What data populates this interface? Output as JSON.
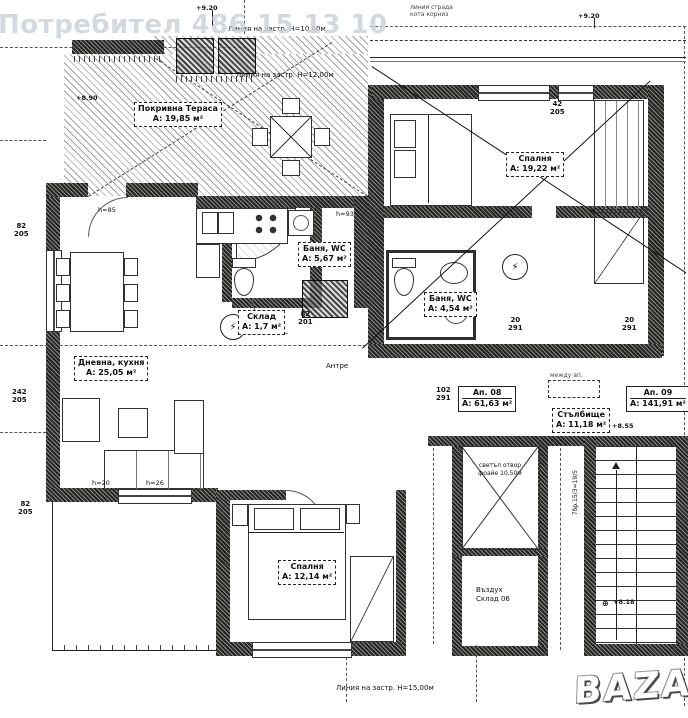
{
  "watermarks": {
    "user": "Потребител 486 15 13 10",
    "logo": "BAZAR"
  },
  "rooms": [
    {
      "name": "Покривна Тераса",
      "area": "А: 19,85 м²"
    },
    {
      "name": "Спалня",
      "area": "А: 19,22 м²"
    },
    {
      "name": "Баня, WC",
      "area": "А: 5,67 м²"
    },
    {
      "name": "Баня, WC",
      "area": "А: 4,54 м²"
    },
    {
      "name": "Склад",
      "area": "А: 1,7 м²"
    },
    {
      "name": "Дневна, кухня",
      "area": "А: 25,05 м²"
    },
    {
      "name": "Ап. 08",
      "area": "А: 61,63 м²"
    },
    {
      "name": "Стълбище",
      "area": "А: 11,18 м²"
    },
    {
      "name": "Ап. 09",
      "area": "А: 141,91 м²"
    },
    {
      "name": "Спалня",
      "area": "А: 12,14 м²"
    }
  ],
  "build_lines": [
    "Линия на застр. Н=10,00м",
    "Линия на застр. Н=12,00м",
    "Линия на застр. Н=15,00м"
  ],
  "small": {
    "top_right_1": "линия сграда",
    "top_right_2": "кота корниз",
    "between": "между ап.",
    "lift_1": "светъл отвор",
    "lift_2": "фоайе 10,50м",
    "air_1": "Въздух",
    "air_2": "Склад 06",
    "anteroom": "Антре",
    "stair_calc": "7бр.15/3=19/5"
  },
  "elevations": [
    "+9.20",
    "+9.20",
    "+8.90",
    "+8.55",
    "+8.18"
  ],
  "heights": [
    "h=85",
    "h=93",
    "h=20",
    "h=26"
  ],
  "dims": [
    {
      "a": "82",
      "b": "205"
    },
    {
      "a": "242",
      "b": "205"
    },
    {
      "a": "82",
      "b": "205"
    },
    {
      "a": "102",
      "b": "291"
    },
    {
      "a": "82",
      "b": "201"
    },
    {
      "a": "20",
      "b": "291"
    },
    {
      "a": "20",
      "b": "291"
    },
    {
      "a": "42",
      "b": "205"
    }
  ],
  "icons": {
    "electrical_panel": "⚡",
    "level_mark": "◈",
    "survey_mark": "⊕"
  }
}
